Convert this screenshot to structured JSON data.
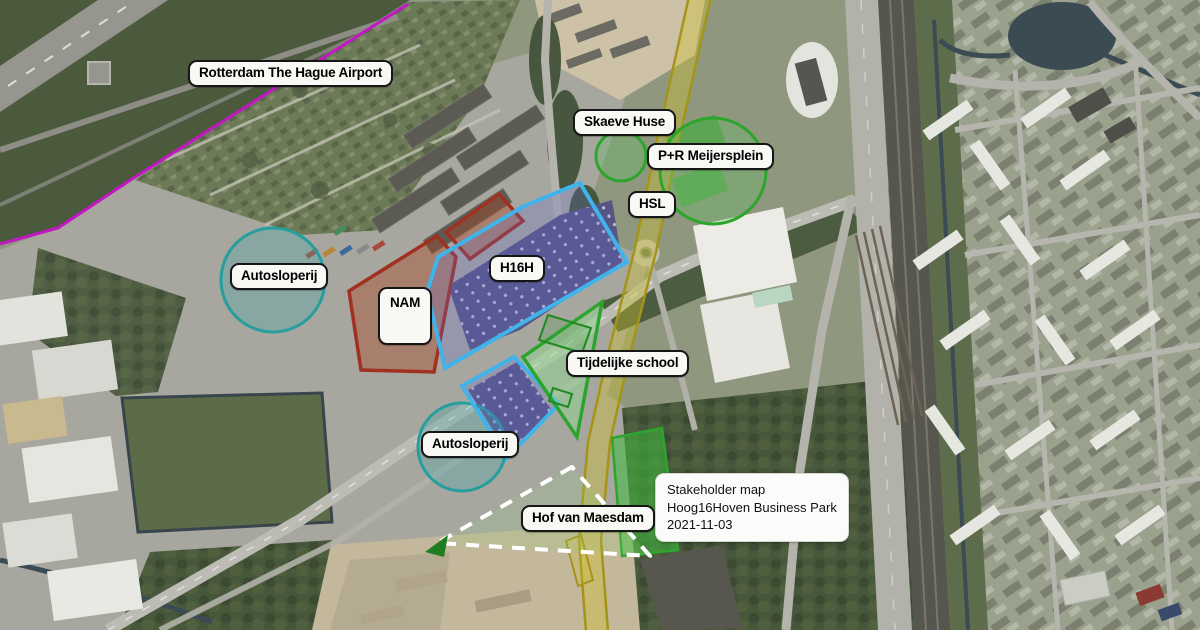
{
  "map": {
    "description": "Aerial stakeholder map of Hoog16Hoven business park area, Rotterdam"
  },
  "labels": {
    "airport": "Rotterdam The Hague Airport",
    "skaeve_huse": "Skaeve Huse",
    "pr_meijersplein": "P+R Meijersplein",
    "hsl": "HSL",
    "h16h": "H16H",
    "nam": "NAM",
    "autosloperij_west": "Autosloperij",
    "autosloperij_south": "Autosloperij",
    "tijdelijke_school": "Tijdelijke school",
    "hof_van_maesdam": "Hof van Maesdam"
  },
  "caption": {
    "lines": [
      "Stakeholder map",
      "Hoog16Hoven Business Park",
      "2021-11-03"
    ]
  },
  "overlays": [
    {
      "name": "airport-boundary-line",
      "type": "polyline",
      "color": "#c516c5",
      "label": "Rotterdam The Hague Airport"
    },
    {
      "name": "hsl-corridor-band",
      "type": "band",
      "color": "#a59417",
      "label": "HSL"
    },
    {
      "name": "nam-site",
      "type": "polygon",
      "stroke": "#a03020",
      "label": "NAM"
    },
    {
      "name": "h16h-site",
      "type": "polygon",
      "stroke": "#41b3eb",
      "label": "H16H"
    },
    {
      "name": "autosloperij-west-area",
      "type": "circle",
      "stroke": "#269e9e",
      "label": "Autosloperij"
    },
    {
      "name": "autosloperij-south-area",
      "type": "circle",
      "stroke": "#269e9e",
      "label": "Autosloperij"
    },
    {
      "name": "skaeve-huse-area",
      "type": "circle",
      "stroke": "#2da52d",
      "label": "Skaeve Huse"
    },
    {
      "name": "pr-meijersplein-area",
      "type": "circle",
      "stroke": "#2da52d",
      "label": "P+R Meijersplein"
    },
    {
      "name": "tijdelijke-school-site",
      "type": "polygon",
      "stroke": "#2da52d",
      "label": "Tijdelijke school"
    },
    {
      "name": "hof-van-maesdam-area",
      "type": "dashed-triangle",
      "stroke": "#ffffff",
      "label": "Hof van Maesdam"
    }
  ],
  "label_style": {
    "background": "#f8f8f5",
    "border": "#161616",
    "text": "#000000"
  }
}
